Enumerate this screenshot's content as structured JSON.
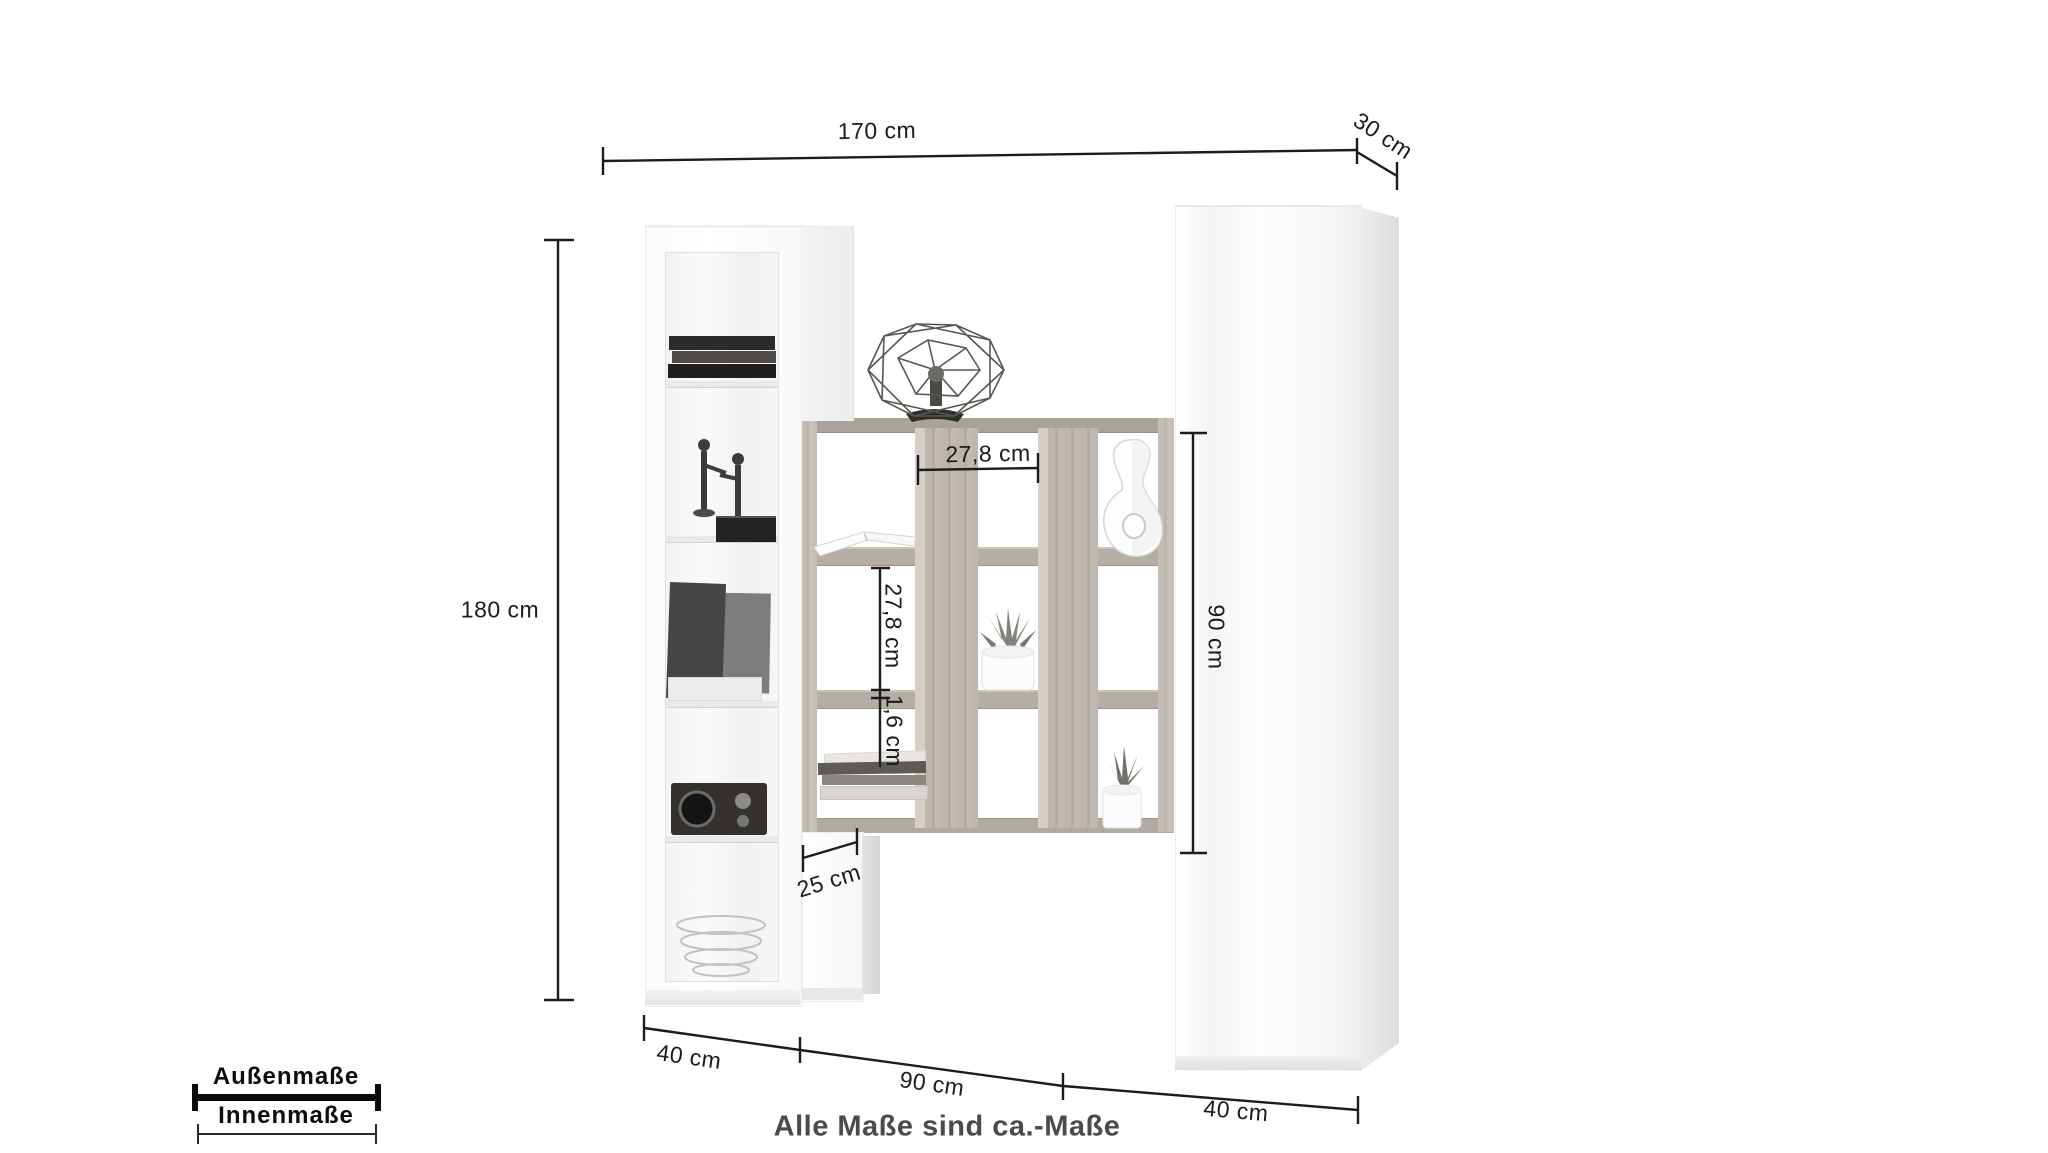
{
  "note": "Alle Maße sind ca.-Maße",
  "legend": {
    "outer": "Außenmaße",
    "inner": "Innenmaße"
  },
  "dims": {
    "top_width": "170 cm",
    "top_depth": "30 cm",
    "left_height": "180 cm",
    "inner_width": "27,8 cm",
    "inner_height": "27,8 cm",
    "panel_thickness": "1,6 cm",
    "shelf_height": "90 cm",
    "leg_depth": "25 cm",
    "bottom_left_width": "40 cm",
    "bottom_center_width": "90 cm",
    "bottom_right_width": "40 cm"
  },
  "colors": {
    "dimension_line": "#1c1c1c",
    "note_text": "#4b4b4b",
    "wood": "#c1bbb3",
    "wood_dark": "#a9a39b",
    "cabinet": "#ffffff"
  }
}
